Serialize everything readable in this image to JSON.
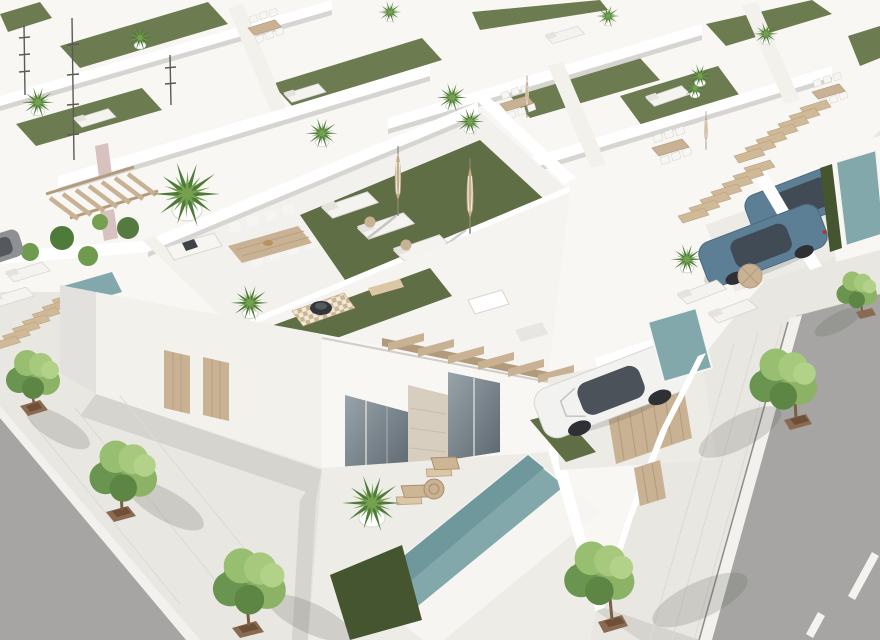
{
  "meta": {
    "type": "3d-architectural-render",
    "view": "aerial-isometric",
    "alt": "Aerial 3D rendering of a modern white villa development: rows of flat-roofed houses with artificial-grass rooftop terraces, sun loungers, closed parasols, outdoor dining tables, a fire pit on a checkered rug, private teal pools, wooden pergolas, gates and stairs, driveways with one white sedan and two blue SUVs, and paved streets lined with green trees in brown planters."
  },
  "palette": {
    "base": "#e9e7e2",
    "road": "#a6a5a3",
    "curb": "#f2f1ee",
    "marking": "#f4f3f0",
    "mass": "#f8f7f4",
    "wall_white": "#ffffff",
    "wall_shade": "#d7d5d1",
    "wall_warm": "#f3f1ec",
    "roof_band": "#f5f4f1",
    "deck": "#f2f1ee",
    "patio": "#eeece7",
    "driveway": "#edebe6",
    "grass_roof": "#5f6e44",
    "grass_light": "#6d7c50",
    "hedge": "#45552f",
    "pool": "#82a8ac",
    "pool_deep": "#6f989d",
    "wood": "#c9b294",
    "wood_dark": "#b29b7c",
    "wood_light": "#dbc7a6",
    "furniture_white": "#f6f5f2",
    "furniture_line": "#d2d0cb",
    "glass": "#7d868d",
    "glass_dark": "#59636b",
    "stone": "#d8cec0",
    "car_white": "#f2f2f0",
    "car_blue": "#5d7f96",
    "car_roof": "#414b55",
    "wheel": "#2e3033",
    "mauve_accent": "#d8c2bf",
    "planter": "#8a6a50",
    "planter_soil": "#6f4f38",
    "tree_mid": "#7fa85c",
    "tree_dark": "#699551",
    "tree_light": "#a6c97d"
  },
  "scene": {
    "ground": {
      "left_street": "asphalt road at lower-left corner",
      "right_street": "asphalt road with white dashed lane marking at lower-right",
      "sidewalks": "light paved pedestrian promenade with joint lines",
      "street_trees": 6,
      "tree_planters": "square rust-brown planters"
    },
    "buildings": {
      "style": "white minimalist villas in parallel rows",
      "rooftop_terraces": [
        "artificial grass lawn",
        "three sun loungers",
        "two closed striped parasols",
        "round wicker side tables",
        "dining table with eight chairs",
        "outdoor kitchen counter with sink",
        "fire pit bowl on checkered rug",
        "potted palm trees",
        "skylight boxes",
        "antenna masts"
      ],
      "facade": [
        "glass sliding doors",
        "stone-clad accent wall",
        "wooden utility doors",
        "wooden pergola beams"
      ]
    },
    "amenities": {
      "pools": [
        "front-yard pool with hedge end",
        "side courtyard plunge pool",
        "street-side plunge pool",
        "walled lap pool at right edge"
      ],
      "wood_elements": [
        "external stair runs",
        "slatted driveway gates",
        "deck chairs",
        "wicker parasol"
      ]
    },
    "vehicles": [
      {
        "type": "sedan",
        "color": "white",
        "location": "center driveway"
      },
      {
        "type": "suv",
        "color": "steel-blue",
        "location": "right driveway"
      },
      {
        "type": "suv",
        "color": "steel-blue",
        "location": "upper-right driveway, partially hidden"
      },
      {
        "type": "car",
        "color": "dark-gray",
        "location": "left edge, partially visible"
      }
    ],
    "counts": {
      "street_trees": 6,
      "visible_cars": 4,
      "pools": 4,
      "terrace_loungers": 3,
      "dining_chairs": 8
    }
  }
}
